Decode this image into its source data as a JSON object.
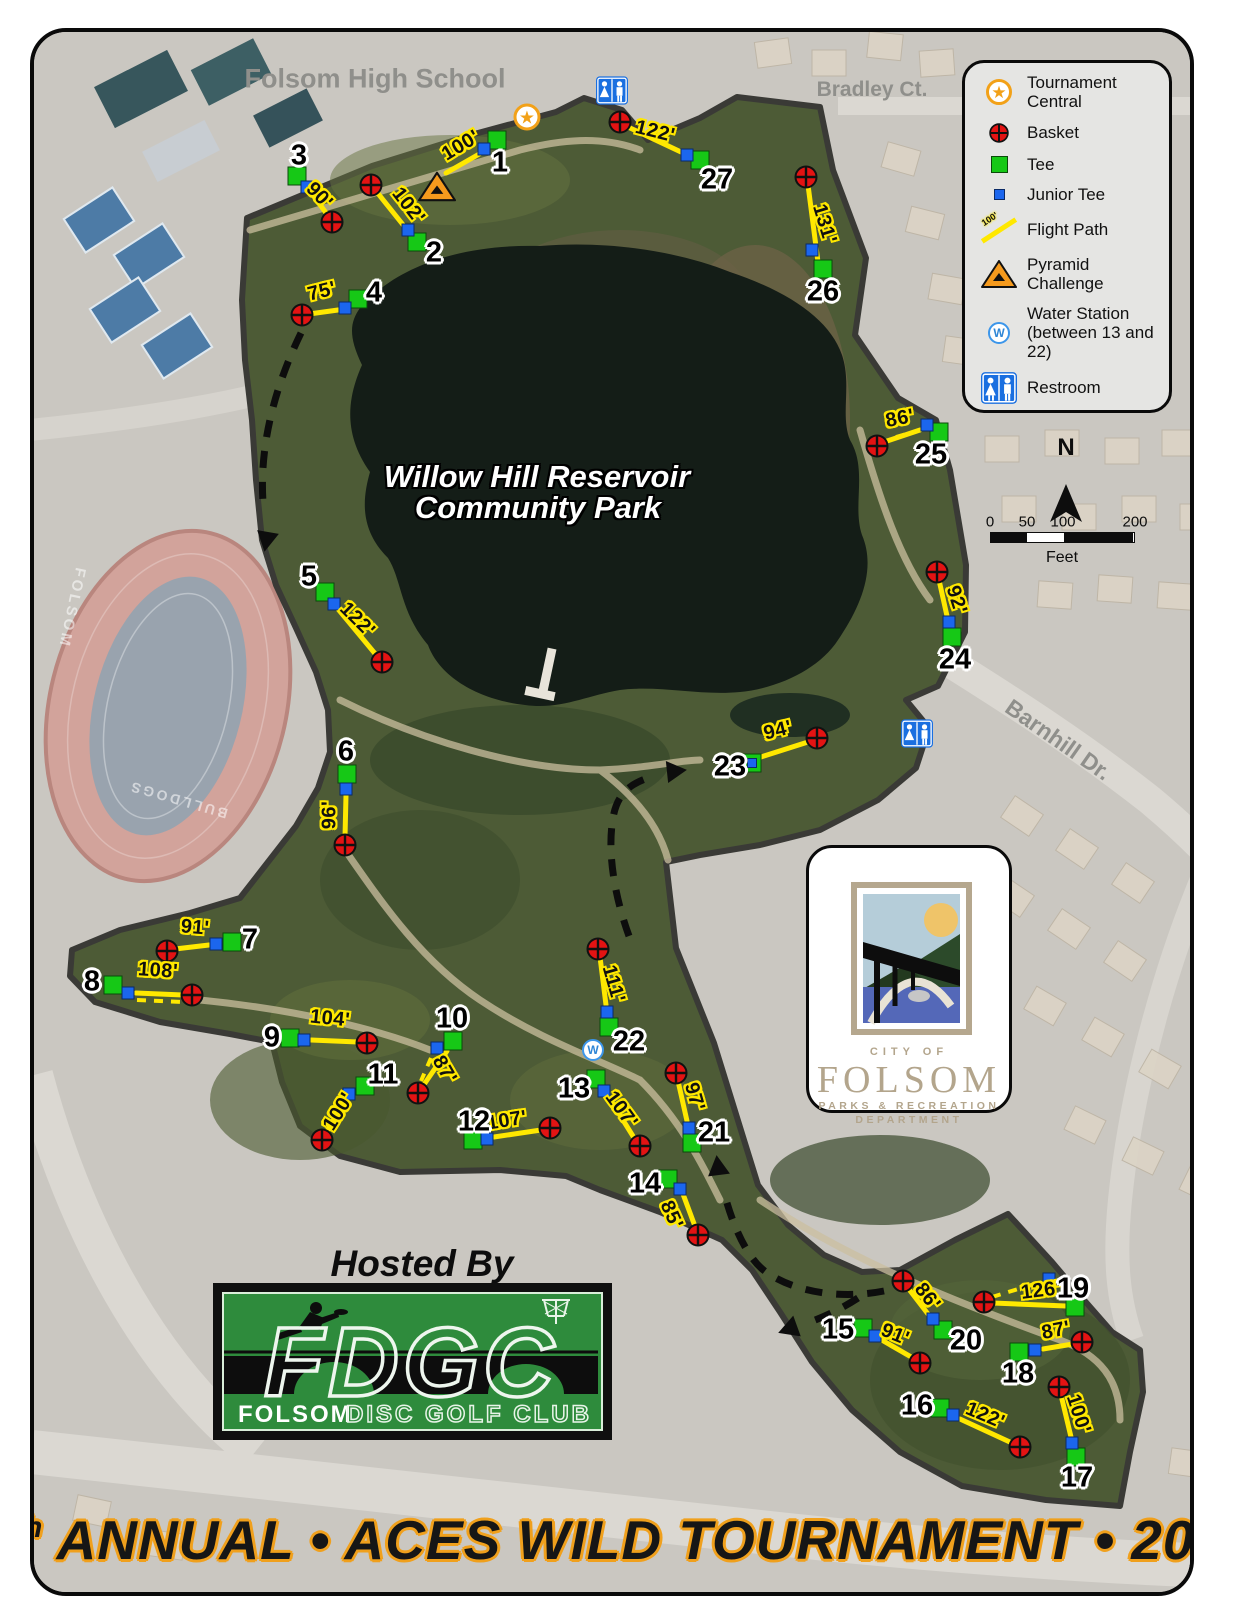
{
  "title": {
    "prefix": "6",
    "sup": "th",
    "rest": " ANNUAL • ACES WILD TOURNAMENT • 2022"
  },
  "hosted_by": "Hosted By",
  "credit": "Map Prepared By: Ben Mundell, Folsom DGC (October 2022)",
  "park": {
    "name_line1": "Willow Hill Reservoir",
    "name_line2": "Community Park"
  },
  "streets": {
    "school": "Folsom High School",
    "bradley": "Bradley Ct.",
    "barnhill": "Barnhill Dr."
  },
  "stadium": {
    "school": "FOLSOM",
    "team": "BULLDOGS"
  },
  "compass": {
    "north": "N"
  },
  "scale_bar": {
    "ticks": [
      "0",
      "50",
      "100",
      "200"
    ],
    "unit": "Feet"
  },
  "water_label": "W",
  "legend": {
    "items": [
      {
        "icon": "tournament-central-icon",
        "label": "Tournament Central"
      },
      {
        "icon": "basket-icon",
        "label": "Basket"
      },
      {
        "icon": "tee-icon",
        "label": "Tee"
      },
      {
        "icon": "junior-tee-icon",
        "label": "Junior Tee"
      },
      {
        "icon": "flight-path-icon",
        "label": "Flight Path",
        "sample": "100'"
      },
      {
        "icon": "pyramid-challenge-icon",
        "label": "Pyramid Challenge"
      },
      {
        "icon": "water-station-icon",
        "label": "Water Station (between 13 and 22)"
      },
      {
        "icon": "restroom-icon",
        "label": "Restroom"
      }
    ]
  },
  "city_logo": {
    "city_of": "CITY OF",
    "name": "FOLSOM",
    "dept_line1": "PARKS & RECREATION",
    "dept_line2": "DEPARTMENT"
  },
  "club_logo": {
    "acronym": "FDGC",
    "club_bold": "FOLSOM",
    "club_rest": "DISC GOLF CLUB"
  },
  "markers": {
    "tournament_central": [
      527,
      117
    ],
    "pyramid_challenge": [
      437,
      189
    ],
    "water_station": [
      593,
      1050
    ],
    "restrooms": [
      [
        612,
        93
      ],
      [
        917,
        736
      ]
    ]
  },
  "colors": {
    "tee": "#16c816",
    "junior_tee": "#1b66ee",
    "basket": "#e31313",
    "flight_path": "#ffe800",
    "pyramid": "#f59a1d",
    "restroom": "#1a6fe0",
    "tournament_star": "#f2a118",
    "title_outline": "#f0a01c"
  },
  "holes": [
    {
      "num": "1",
      "dist": "100'",
      "num_pos": [
        500,
        163
      ],
      "tee": [
        497,
        140
      ],
      "jr": [
        484,
        149
      ],
      "basket": null,
      "line": [
        481,
        153,
        446,
        173
      ],
      "label": [
        461,
        146
      ],
      "angle": -31,
      "alt": null
    },
    {
      "num": "2",
      "dist": "102'",
      "num_pos": [
        434,
        253
      ],
      "tee": [
        417,
        242
      ],
      "jr": [
        408,
        230
      ],
      "basket": [
        371,
        185
      ],
      "line": [
        404,
        226,
        376,
        191
      ],
      "label": [
        408,
        206
      ],
      "angle": 52,
      "alt": null
    },
    {
      "num": "3",
      "dist": "90'",
      "num_pos": [
        299,
        156
      ],
      "tee": [
        297,
        176
      ],
      "jr": [
        307,
        187
      ],
      "basket": [
        332,
        222
      ],
      "line": [
        310,
        191,
        329,
        217
      ],
      "label": [
        319,
        196
      ],
      "angle": 46,
      "alt": null
    },
    {
      "num": "4",
      "dist": "75'",
      "num_pos": [
        374,
        293
      ],
      "tee": [
        358,
        299
      ],
      "jr": [
        345,
        308
      ],
      "basket": [
        302,
        315
      ],
      "line": [
        338,
        310,
        309,
        314
      ],
      "label": [
        322,
        292
      ],
      "angle": -14,
      "alt": null
    },
    {
      "num": "5",
      "dist": "122'",
      "num_pos": [
        309,
        577
      ],
      "tee": [
        325,
        592
      ],
      "jr": [
        334,
        604
      ],
      "basket": [
        382,
        662
      ],
      "line": [
        338,
        609,
        377,
        656
      ],
      "label": [
        357,
        620
      ],
      "angle": 45,
      "alt": null
    },
    {
      "num": "6",
      "dist": "96'",
      "num_pos": [
        346,
        752
      ],
      "tee": [
        347,
        774
      ],
      "jr": [
        346,
        789
      ],
      "basket": [
        345,
        845
      ],
      "line": [
        346,
        795,
        345,
        837
      ],
      "label": [
        330,
        815
      ],
      "angle": -90,
      "alt": null
    },
    {
      "num": "7",
      "dist": "91'",
      "num_pos": [
        250,
        940
      ],
      "tee": [
        232,
        942
      ],
      "jr": [
        216,
        944
      ],
      "basket": [
        167,
        951
      ],
      "line": [
        209,
        945,
        175,
        949
      ],
      "label": [
        195,
        928
      ],
      "angle": 5,
      "alt": null
    },
    {
      "num": "8",
      "dist": "108'",
      "num_pos": [
        92,
        982
      ],
      "tee": [
        113,
        985
      ],
      "jr": [
        128,
        993
      ],
      "basket": [
        192,
        995
      ],
      "line": [
        136,
        993,
        183,
        995
      ],
      "label": [
        158,
        971
      ],
      "angle": 4,
      "alt": [
        137,
        1000,
        184,
        1002
      ]
    },
    {
      "num": "9",
      "dist": "104'",
      "num_pos": [
        272,
        1038
      ],
      "tee": [
        290,
        1038
      ],
      "jr": [
        304,
        1040
      ],
      "basket": [
        367,
        1043
      ],
      "line": [
        311,
        1040,
        358,
        1042
      ],
      "label": [
        330,
        1019
      ],
      "angle": 6,
      "alt": null
    },
    {
      "num": "10",
      "dist": "87'",
      "num_pos": [
        452,
        1019
      ],
      "tee": [
        453,
        1041
      ],
      "jr": [
        437,
        1048
      ],
      "basket": [
        418,
        1093
      ],
      "line": [
        447,
        1051,
        423,
        1086
      ],
      "label": [
        444,
        1070
      ],
      "angle": 60,
      "alt": [
        431,
        1058,
        421,
        1081
      ]
    },
    {
      "num": "11",
      "dist": "100'",
      "num_pos": [
        383,
        1075
      ],
      "tee": [
        365,
        1086
      ],
      "jr": [
        349,
        1094
      ],
      "basket": [
        322,
        1140
      ],
      "line": [
        345,
        1100,
        326,
        1133
      ],
      "label": [
        339,
        1112
      ],
      "angle": -58,
      "alt": null
    },
    {
      "num": "12",
      "dist": "107'",
      "num_pos": [
        474,
        1122
      ],
      "tee": [
        473,
        1140
      ],
      "jr": [
        487,
        1139
      ],
      "basket": [
        550,
        1128
      ],
      "line": [
        494,
        1137,
        541,
        1130
      ],
      "label": [
        507,
        1121
      ],
      "angle": -9,
      "alt": null
    },
    {
      "num": "13",
      "dist": "107'",
      "num_pos": [
        574,
        1089
      ],
      "tee": [
        596,
        1079
      ],
      "jr": [
        604,
        1091
      ],
      "basket": [
        640,
        1146
      ],
      "line": [
        608,
        1096,
        636,
        1141
      ],
      "label": [
        621,
        1110
      ],
      "angle": 54,
      "alt": null
    },
    {
      "num": "14",
      "dist": "85'",
      "num_pos": [
        645,
        1184
      ],
      "tee": [
        668,
        1179
      ],
      "jr": [
        680,
        1189
      ],
      "basket": [
        698,
        1235
      ],
      "line": [
        683,
        1194,
        696,
        1229
      ],
      "label": [
        671,
        1215
      ],
      "angle": 66,
      "alt": null
    },
    {
      "num": "15",
      "dist": "91'",
      "num_pos": [
        838,
        1330
      ],
      "tee": [
        863,
        1328
      ],
      "jr": [
        875,
        1336
      ],
      "basket": [
        920,
        1363
      ],
      "line": [
        880,
        1339,
        913,
        1358
      ],
      "label": [
        895,
        1335
      ],
      "angle": 22,
      "alt": null
    },
    {
      "num": "16",
      "dist": "122'",
      "num_pos": [
        917,
        1406
      ],
      "tee": [
        940,
        1408
      ],
      "jr": [
        953,
        1415
      ],
      "basket": [
        1020,
        1447
      ],
      "line": [
        960,
        1419,
        1012,
        1443
      ],
      "label": [
        985,
        1416
      ],
      "angle": 23,
      "alt": null
    },
    {
      "num": "17",
      "dist": "100'",
      "num_pos": [
        1077,
        1478
      ],
      "tee": [
        1076,
        1457
      ],
      "jr": [
        1072,
        1443
      ],
      "basket": [
        1059,
        1387
      ],
      "line": [
        1071,
        1437,
        1061,
        1395
      ],
      "label": [
        1078,
        1414
      ],
      "angle": 72,
      "alt": null
    },
    {
      "num": "18",
      "dist": "87'",
      "num_pos": [
        1018,
        1374
      ],
      "tee": [
        1019,
        1352
      ],
      "jr": [
        1035,
        1350
      ],
      "basket": [
        1082,
        1342
      ],
      "line": [
        1043,
        1349,
        1073,
        1344
      ],
      "label": [
        1056,
        1331
      ],
      "angle": -11,
      "alt": null
    },
    {
      "num": "19",
      "dist": "126'",
      "num_pos": [
        1073,
        1289
      ],
      "tee": [
        1075,
        1307
      ],
      "jr": [
        1049,
        1279
      ],
      "basket": [
        984,
        1302
      ],
      "line": [
        1066,
        1306,
        993,
        1303
      ],
      "label": [
        1041,
        1291
      ],
      "angle": -7,
      "alt": [
        992,
        1297,
        1041,
        1282
      ]
    },
    {
      "num": "20",
      "dist": "86'",
      "num_pos": [
        966,
        1341
      ],
      "tee": [
        943,
        1330
      ],
      "jr": [
        933,
        1319
      ],
      "basket": [
        903,
        1281
      ],
      "line": [
        928,
        1314,
        908,
        1288
      ],
      "label": [
        927,
        1297
      ],
      "angle": 52,
      "alt": null
    },
    {
      "num": "21",
      "dist": "97'",
      "num_pos": [
        714,
        1133
      ],
      "tee": [
        692,
        1143
      ],
      "jr": [
        689,
        1128
      ],
      "basket": [
        676,
        1073
      ],
      "line": [
        687,
        1121,
        678,
        1081
      ],
      "label": [
        694,
        1097
      ],
      "angle": 74,
      "alt": null
    },
    {
      "num": "22",
      "dist": "111'",
      "num_pos": [
        629,
        1042
      ],
      "tee": [
        609,
        1027
      ],
      "jr": [
        607,
        1012
      ],
      "basket": [
        598,
        949
      ],
      "line": [
        606,
        1005,
        600,
        957
      ],
      "label": [
        613,
        984
      ],
      "angle": 74,
      "alt": null
    },
    {
      "num": "23",
      "dist": "94'",
      "num_pos": [
        730,
        767
      ],
      "tee": [
        752,
        763
      ],
      "jr": [
        752,
        763
      ],
      "jr_on_tee": true,
      "basket": [
        817,
        738
      ],
      "line": [
        761,
        757,
        808,
        742
      ],
      "label": [
        778,
        731
      ],
      "angle": -14,
      "alt": null
    },
    {
      "num": "24",
      "dist": "92'",
      "num_pos": [
        955,
        660
      ],
      "tee": [
        952,
        637
      ],
      "jr": [
        949,
        622
      ],
      "basket": [
        937,
        572
      ],
      "line": [
        947,
        616,
        939,
        580
      ],
      "label": [
        956,
        600
      ],
      "angle": 72,
      "alt": null
    },
    {
      "num": "25",
      "dist": "86'",
      "num_pos": [
        931,
        455
      ],
      "tee": [
        939,
        432
      ],
      "jr": [
        927,
        425
      ],
      "basket": [
        877,
        446
      ],
      "line": [
        920,
        430,
        884,
        442
      ],
      "label": [
        900,
        419
      ],
      "angle": -11,
      "alt": [
        896,
        437,
        924,
        429
      ]
    },
    {
      "num": "26",
      "dist": "131'",
      "num_pos": [
        823,
        292
      ],
      "tee": [
        823,
        269
      ],
      "jr": [
        812,
        250
      ],
      "basket": [
        806,
        177
      ],
      "line": [
        818,
        262,
        808,
        185
      ],
      "label": [
        824,
        224
      ],
      "angle": 73,
      "alt": null
    },
    {
      "num": "27",
      "dist": "122'",
      "num_pos": [
        717,
        180
      ],
      "tee": [
        700,
        160
      ],
      "jr": [
        687,
        155
      ],
      "basket": [
        620,
        122
      ],
      "line": [
        681,
        152,
        628,
        127
      ],
      "label": [
        655,
        132
      ],
      "angle": 14,
      "alt": null
    }
  ]
}
